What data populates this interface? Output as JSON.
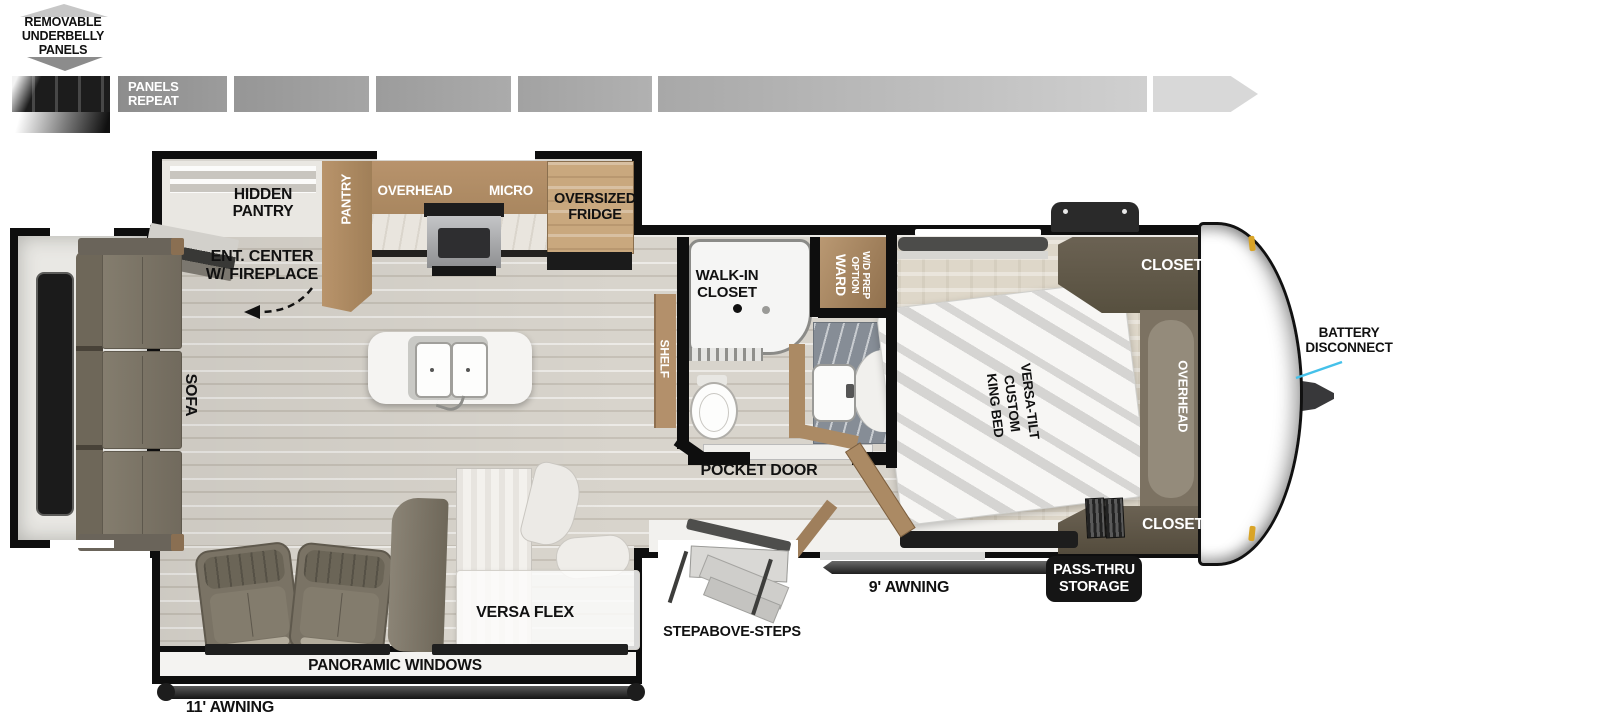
{
  "underbelly": {
    "title": "REMOVABLE\nUNDERBELLY\nPANELS",
    "panels_repeat": "PANELS\nREPEAT"
  },
  "kitchen": {
    "hidden_pantry": "HIDDEN\nPANTRY",
    "pantry": "PANTRY",
    "overhead": "OVERHEAD",
    "micro": "MICRO",
    "fridge": "OVERSIZED\nFRIDGE"
  },
  "living": {
    "ent_center": "ENT. CENTER\nW/ FIREPLACE",
    "sofa": "SOFA",
    "versa_flex": "VERSA FLEX",
    "panoramic_windows": "PANORAMIC WINDOWS",
    "awning_11": "11' AWNING"
  },
  "bath": {
    "shelf": "SHELF",
    "walk_in_closet": "WALK-IN\nCLOSET",
    "ward": "WARD",
    "ward_option": "W/D PREP\nOPTION",
    "pocket_door": "POCKET DOOR"
  },
  "bedroom": {
    "closet_top": "CLOSET",
    "overhead": "OVERHEAD",
    "closet_bottom": "CLOSET",
    "bed": "VERSA-TILT\nCUSTOM\nKING BED"
  },
  "exterior": {
    "battery_disconnect": "BATTERY\nDISCONNECT",
    "pass_thru_storage": "PASS-THRU\nSTORAGE",
    "awning_9": "9' AWNING",
    "steps": "STEPABOVE-STEPS"
  },
  "colors": {
    "wall_black": "#0e0e0e",
    "cabinet_brown": "#b08a63",
    "fridge_brown": "#c9a87e",
    "closet_walnut": "#5e5546",
    "upholstery_olive": "#7b7466",
    "callout_cyan": "#45c1ea",
    "clearance_orange": "#d9a427",
    "panel_gray": "#a5a5a5"
  }
}
